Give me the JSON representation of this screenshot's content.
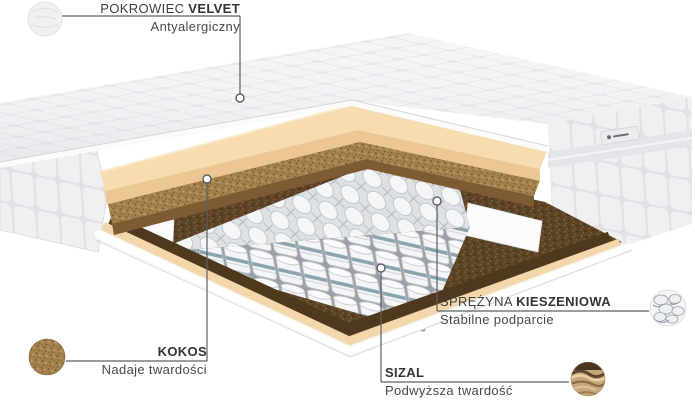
{
  "diagram_title": "Mattress layers diagram",
  "labels": {
    "cover": {
      "prefix": "POKROWIEC",
      "emphasis": "VELVET",
      "description": "Antyalergiczny"
    },
    "kokos": {
      "emphasis": "KOKOS",
      "description": "Nadaje twardości"
    },
    "sizal": {
      "emphasis": "SIZAL",
      "description": "Podwyższa twardość"
    },
    "sprezyna": {
      "prefix": "SPRĘŻYNA",
      "emphasis": "KIESZENIOWA",
      "description": "Stabilne podparcie"
    }
  },
  "swatches": {
    "velvet": "velvet-fabric-sample",
    "kokos": "coconut-fiber-sample",
    "sizal": "sisal-fiber-sample",
    "sprezyna": "pocket-springs-sample"
  },
  "colors": {
    "background": "#ffffff",
    "label_text": "#3c3f42",
    "leader_line": "#5c5f63",
    "cover_white": "#f4f4f6",
    "foam_cream": "#f6dcae",
    "coconut_brown": "#a6824f",
    "sisal_dark": "#5c4325",
    "spring_band_teal": "#7e9ba7",
    "sisal_swatch_tan": "#c7a67a"
  }
}
